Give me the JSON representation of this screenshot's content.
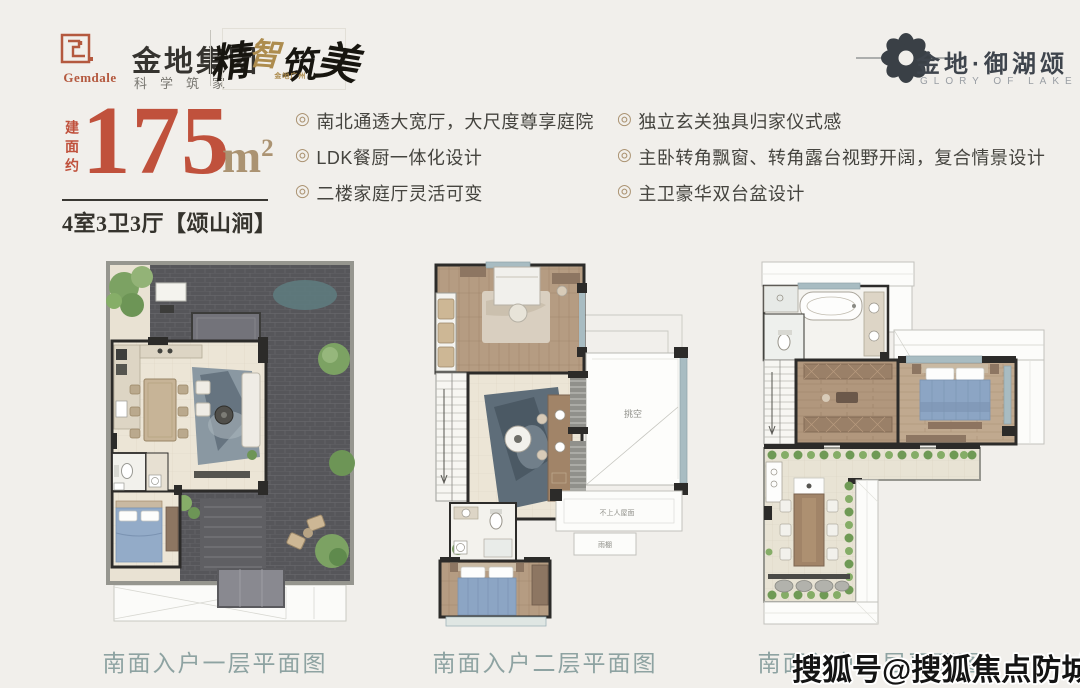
{
  "header": {
    "gemdale_en": "Gemdale",
    "brand_name": "金地集团",
    "brand_slogan": "科学筑家",
    "calligraphy": {
      "c1": "精",
      "c2": "智",
      "c3": "筑",
      "c4": "美",
      "sub": "金地广州"
    },
    "project": {
      "name": "金地·御湖颂",
      "subtitle": "GLORY OF LAKE"
    }
  },
  "unit": {
    "area_prefix": "建面约",
    "area_value": "175",
    "area_unit": "m",
    "area_exponent": "2",
    "layout": "4室3卫3厅【颂山涧】"
  },
  "features": {
    "bullet": "◎",
    "left": [
      "南北通透大宽厅，大尺度尊享庭院",
      "LDK餐厨一体化设计",
      "二楼家庭厅灵活可变"
    ],
    "right": [
      "独立玄关独具归家仪式感",
      "主卧转角飘窗、转角露台视野开阔，复合情景设计",
      "主卫豪华双台盆设计"
    ]
  },
  "plans": [
    {
      "caption": "南面入户一层平面图"
    },
    {
      "caption": "南面入户二层平面图",
      "labels": {
        "void": "挑空",
        "roof": "不上人屋面",
        "canopy": "雨棚"
      }
    },
    {
      "caption": "南面入户三层平面图"
    }
  ],
  "watermark": "搜狐号@搜狐焦点防城港站",
  "colors": {
    "background": "#f1efeb",
    "accent_red": "#c0513c",
    "accent_gold": "#ab9372",
    "caption_teal": "#8ea3a2",
    "logo_dark": "#3a4046"
  }
}
